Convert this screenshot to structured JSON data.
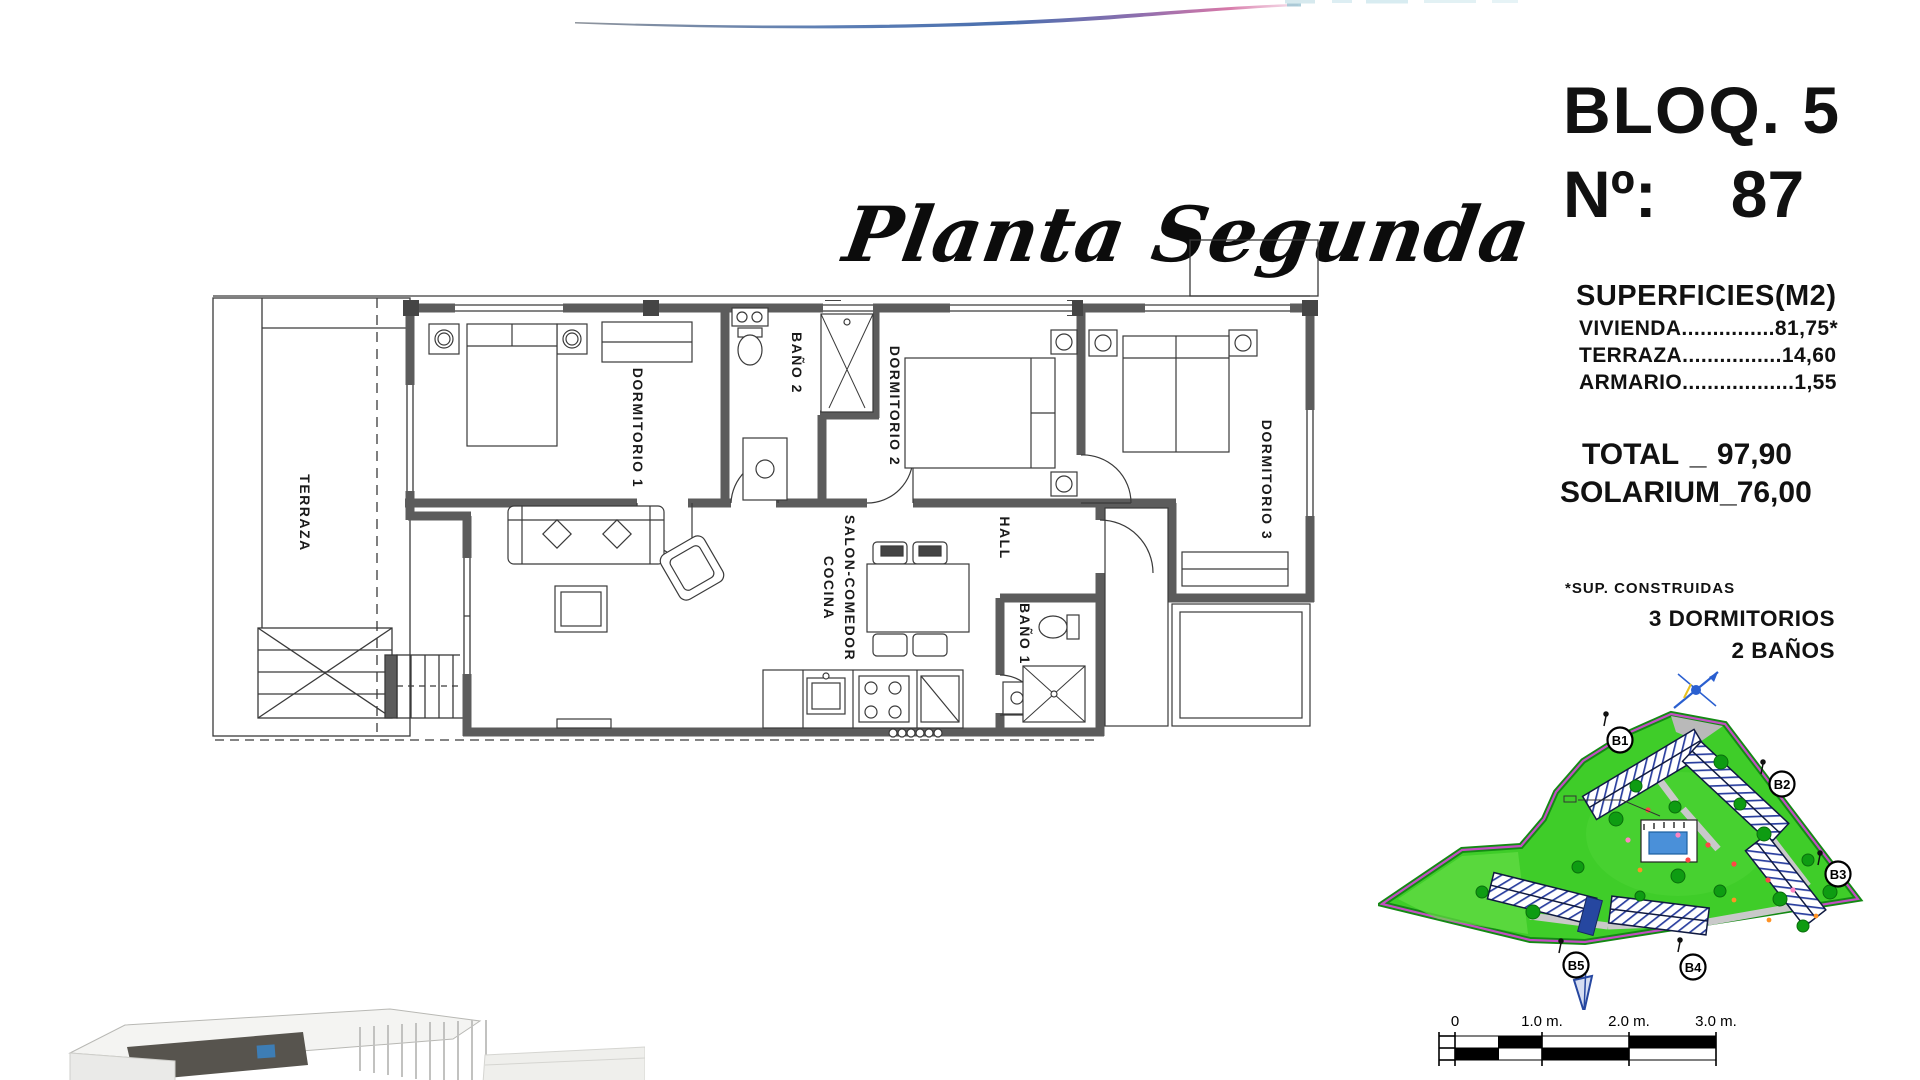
{
  "title": "Planta Segunda",
  "unit": {
    "block": "BLOQ. 5",
    "number_label": "Nº:",
    "number": "87"
  },
  "surfaces": {
    "heading": "SUPERFICIES(M2)",
    "rows": [
      {
        "label": "VIVIENDA",
        "leader": "...............",
        "value": "81,75*"
      },
      {
        "label": "TERRAZA",
        "leader": "................",
        "value": "14,60"
      },
      {
        "label": "ARMARIO",
        "leader": "..................",
        "value": "1,55"
      }
    ],
    "total": {
      "label": "TOTAL",
      "sep": "_",
      "value": "97,90"
    },
    "solarium": {
      "label": "SOLARIUM",
      "sep": "_",
      "value": "76,00"
    },
    "footnote": "*SUP. CONSTRUIDAS",
    "program": {
      "bedrooms": "3 DORMITORIOS",
      "bathrooms": "2 BAÑOS"
    }
  },
  "floorplan": {
    "labels": {
      "terraza": "TERRAZA",
      "dorm1": "DORMITORIO 1",
      "bano2": "BAÑO 2",
      "dorm2": "DORMITORIO 2",
      "dorm3": "DORMITORIO 3",
      "salon_line1": "SALON-COMEDOR",
      "salon_line2": "COCINA",
      "hall": "HALL",
      "bano1": "BAÑO 1"
    }
  },
  "siteplan": {
    "labels": {
      "b1": "B1",
      "b2": "B2",
      "b3": "B3",
      "b4": "B4",
      "b5": "B5"
    },
    "colors": {
      "lawn": "#3fcd29",
      "boundary": "#c34ec3",
      "hatch": "#2a3f9f",
      "pool": "#4a90d9"
    }
  },
  "scalebar": {
    "t0": "0",
    "t1": "1.0 m.",
    "t2": "2.0 m.",
    "t3": "3.0 m."
  },
  "decor": {
    "swoosh_blue": "#4a6fae",
    "swoosh_pink": "#d678a8"
  }
}
